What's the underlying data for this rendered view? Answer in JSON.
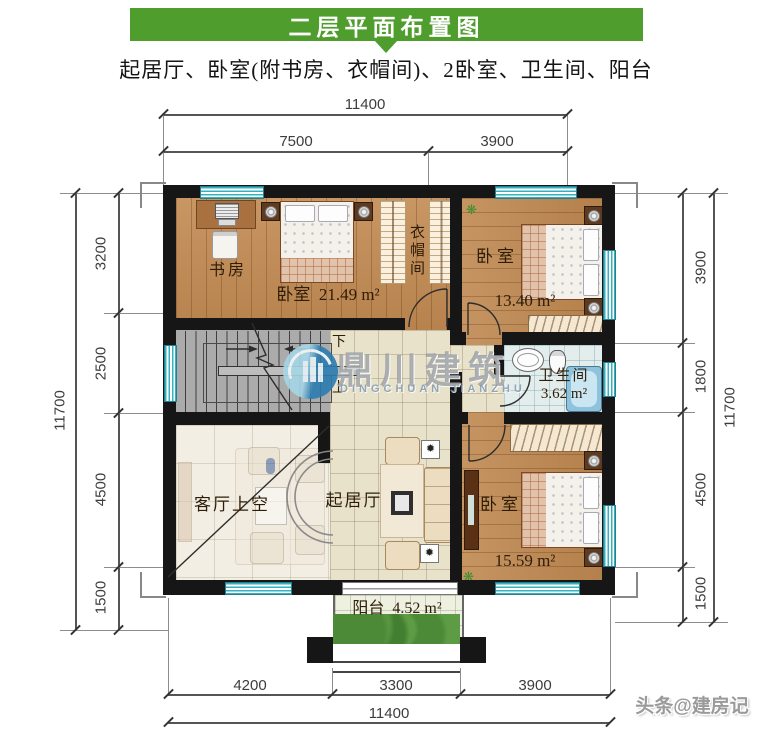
{
  "header": {
    "title": "二层平面布置图",
    "subtitle": "起居厅、卧室(附书房、衣帽间)、2卧室、卫生间、阳台"
  },
  "watermark": {
    "cn": "鼎川建筑",
    "en": "DINGCHUAN JIANZHU"
  },
  "credit": "头条@建房记",
  "rooms": {
    "study": {
      "label": "书房"
    },
    "bedroom_main": {
      "label": "卧室",
      "area": "21.49 m²"
    },
    "cloakroom": {
      "label": "衣帽间"
    },
    "bedroom_right": {
      "label": "卧室",
      "area": "13.40 m²"
    },
    "bathroom": {
      "label": "卫生间",
      "area": "3.62 m²"
    },
    "bedroom_bottom": {
      "label": "卧室",
      "area": "15.59 m²"
    },
    "living_void": {
      "label": "客厅上空"
    },
    "family_room": {
      "label": "起居厅"
    },
    "balcony": {
      "label": "阳台",
      "area": "4.52 m²"
    },
    "stairs": {
      "down": "下",
      "up": "上"
    }
  },
  "dimensions": {
    "top_total": "11400",
    "top_segments": [
      "7500",
      "3900"
    ],
    "left_segments": [
      "3200",
      "2500",
      "4500",
      "1500"
    ],
    "left_total": "11700",
    "right_segments": [
      "3900",
      "1800",
      "4500",
      "1500"
    ],
    "right_total": "11700",
    "bottom_segments": [
      "4200",
      "3300",
      "3900"
    ],
    "bottom_total": "11400"
  },
  "colors": {
    "header_green": "#4f9d2d",
    "wall_black": "#161616",
    "wood_floor": "#c0874d",
    "tile_beige": "#e9e2cb",
    "stair_gray": "#ababab",
    "window_teal": "#35b0c0",
    "bath_blue": "#8fc3dc",
    "greenery_green": "#4c8a38",
    "logo_blue": "#2b7cb0"
  }
}
